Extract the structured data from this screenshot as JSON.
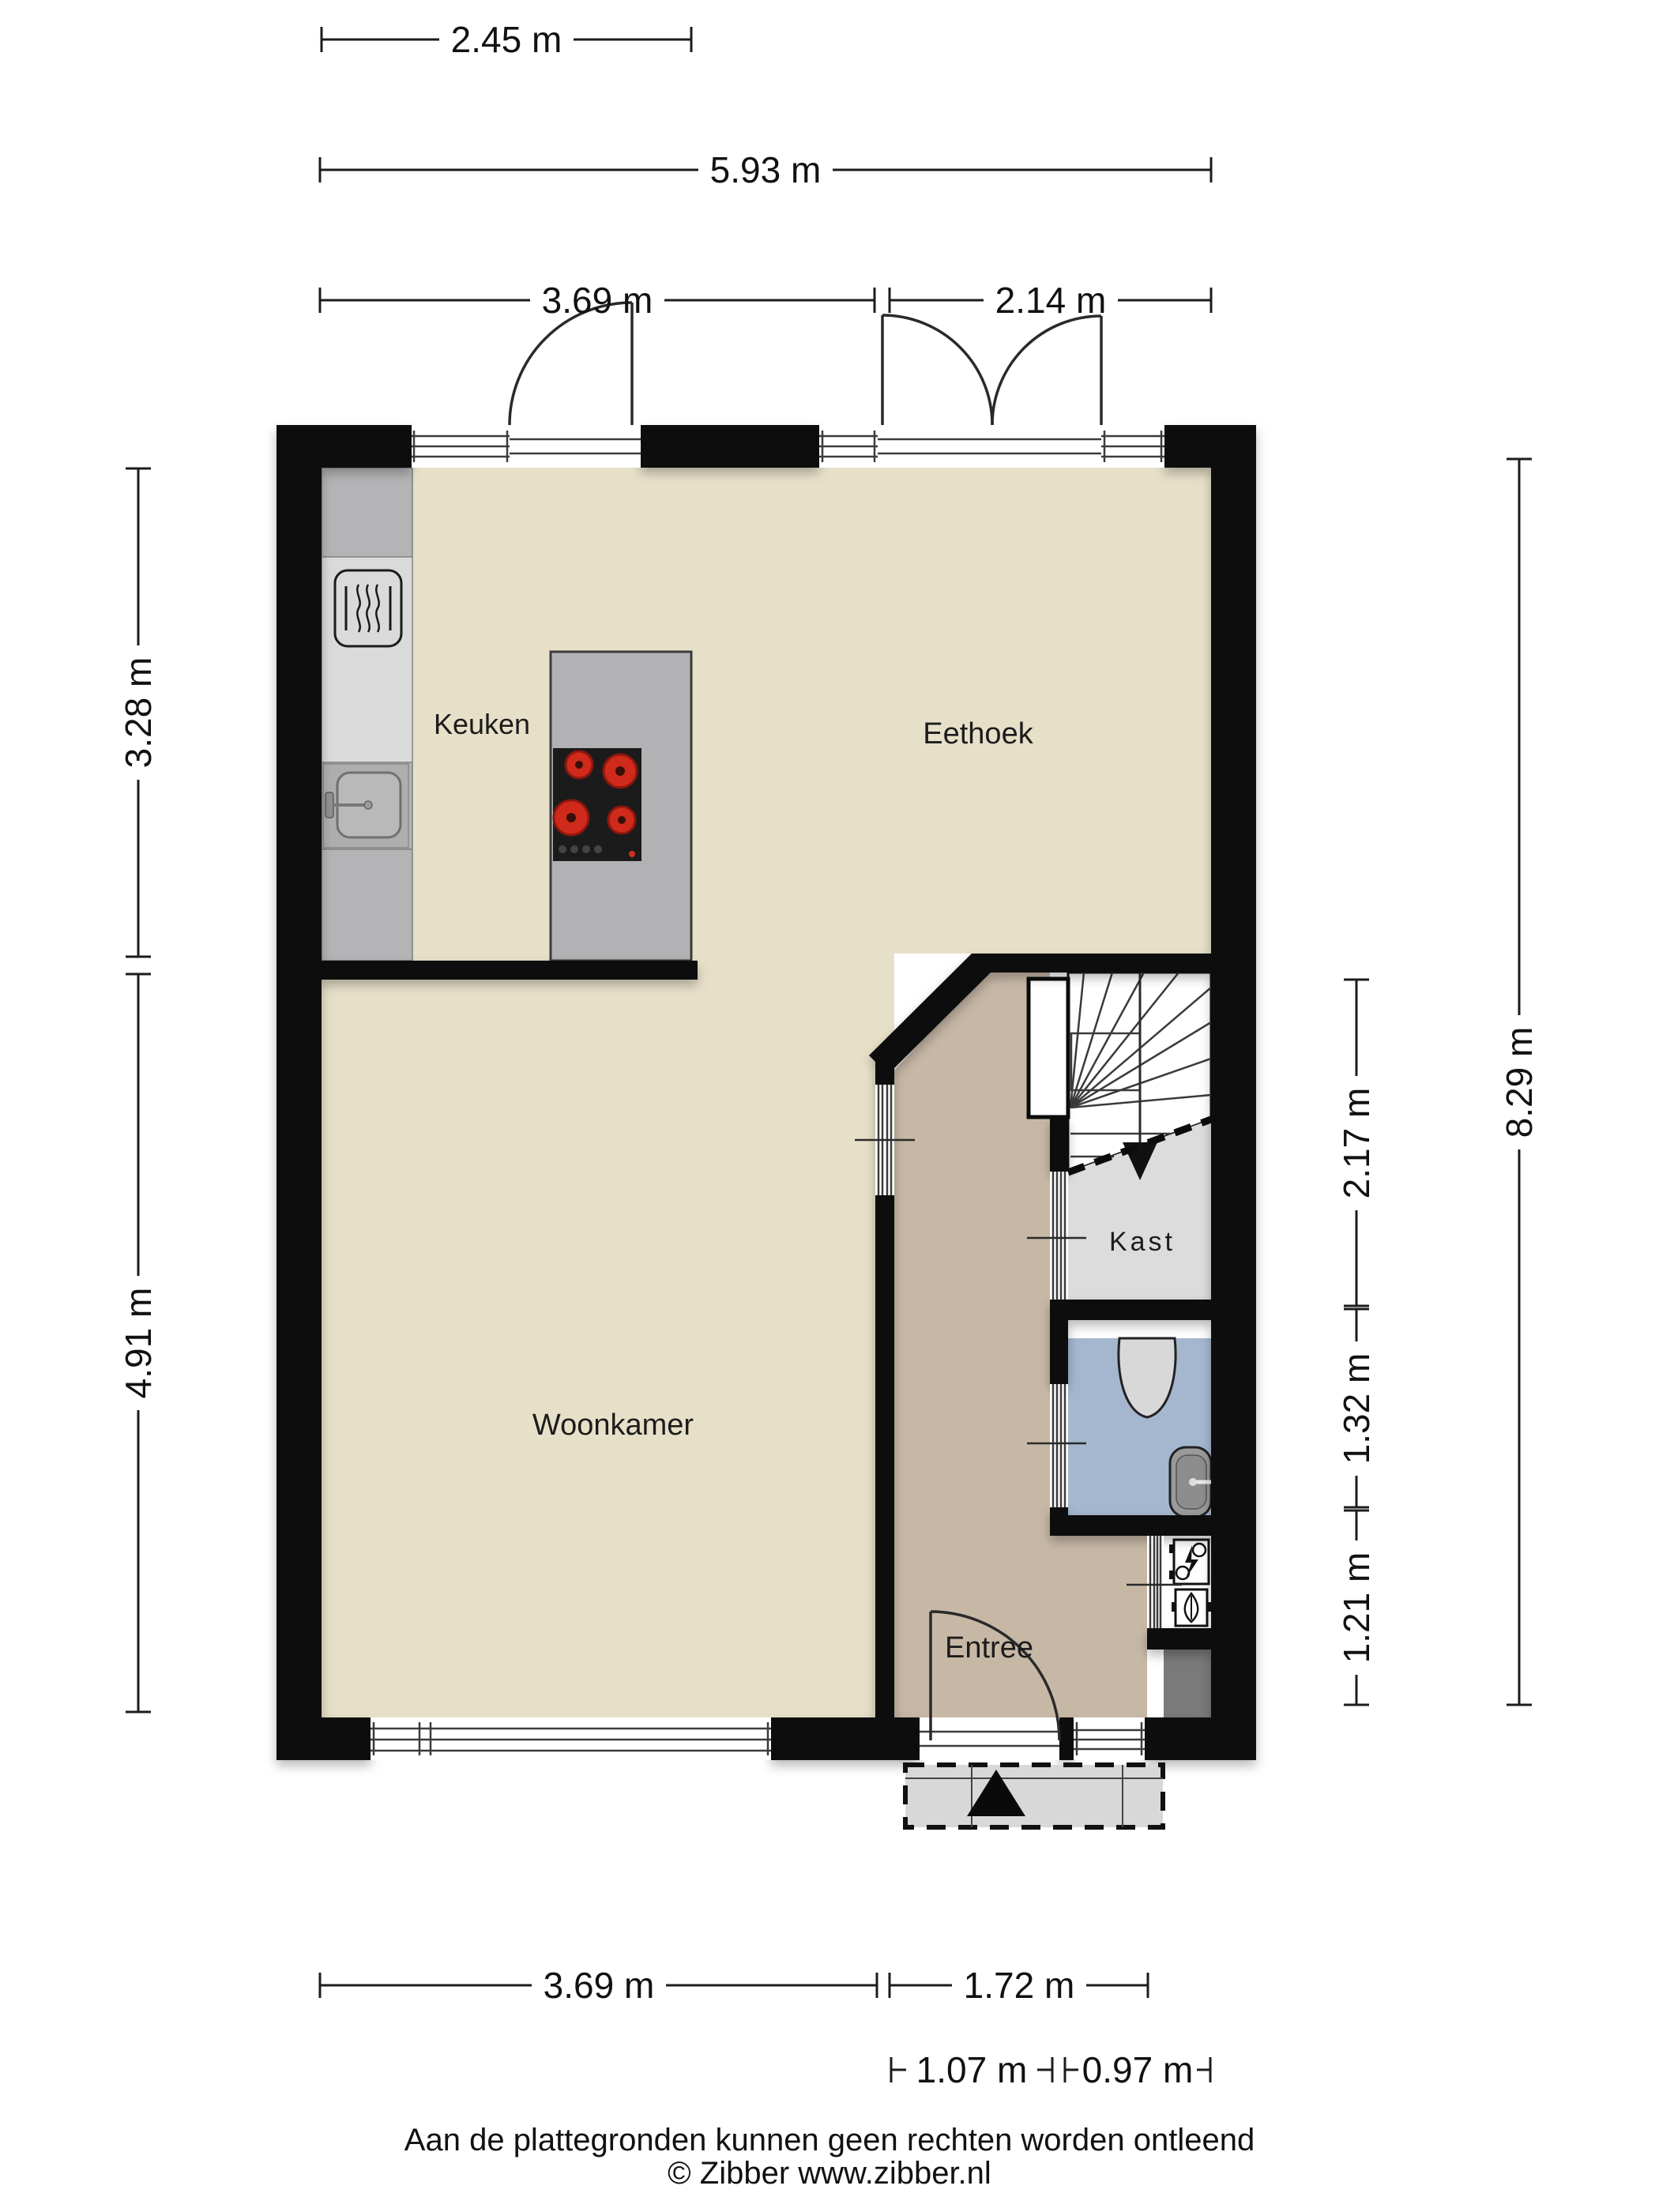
{
  "labels": {
    "kitchen": "Keuken",
    "dining": "Eethoek",
    "living": "Woonkamer",
    "entry": "Entree",
    "closet": "Kast"
  },
  "dimensions": {
    "top_kitchen_width": "2.45 m",
    "top_total_width": "5.93 m",
    "top_left_width": "3.69 m",
    "top_right_width": "2.14 m",
    "left_kitchen_depth": "3.28 m",
    "left_living_depth": "4.91 m",
    "right_stairs_depth": "2.17 m",
    "right_toilet_depth": "1.32 m",
    "right_meter_depth": "1.21 m",
    "right_total_depth": "8.29 m",
    "bottom_living_width": "3.69 m",
    "bottom_entry_width": "1.72 m",
    "bottom_porch_left": "1.07 m",
    "bottom_porch_right": "0.97 m"
  },
  "footer": {
    "disclaimer": "Aan de plattegronden kunnen geen rechten worden ontleend",
    "copyright": "© Zibber www.zibber.nl"
  },
  "colors": {
    "wall": "#0b0b0b",
    "floor_main": "#e7e0c9",
    "floor_entry": "#c7b8a6",
    "floor_toilet": "#a4b7cf",
    "floor_closet": "#dcdcdc",
    "porch": "#d8d8d8",
    "counter": "#b4b4b6",
    "island": "#b2b2b4",
    "oven_panel": "#dadada",
    "stove": "#1b1b1b",
    "burner": "#cf2a1b",
    "duct": "#7a7a7a"
  }
}
